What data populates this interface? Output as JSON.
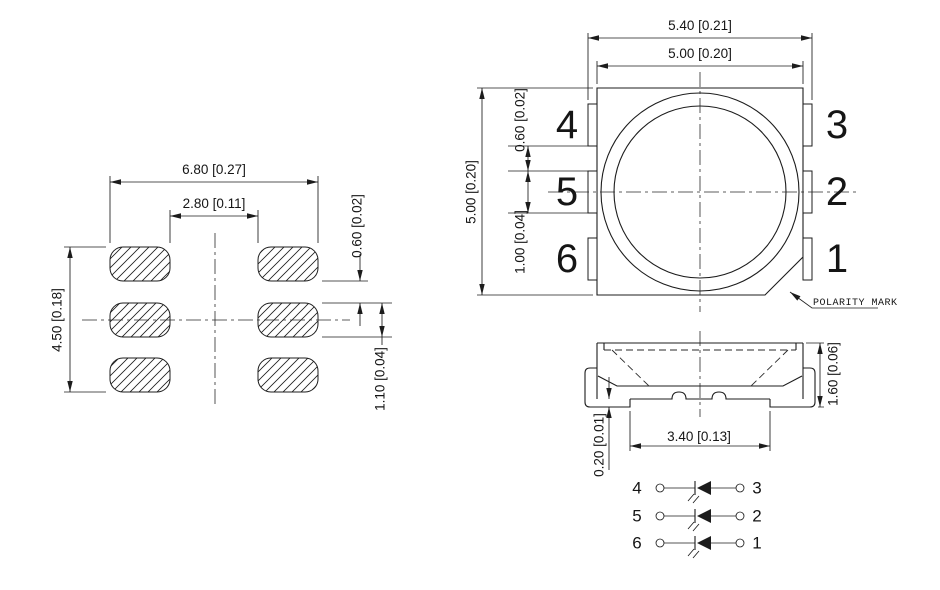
{
  "drawing": {
    "footprint": {
      "dim_outer_width": "6.80 [0.27]",
      "dim_inner_width": "2.80 [0.11]",
      "dim_overall_height": "4.50 [0.18]",
      "dim_pad_gap": "0.60 [0.02]",
      "dim_pad_height": "1.10 [0.04]"
    },
    "top_view": {
      "dim_overall_width": "5.40 [0.21]",
      "dim_body_width": "5.00 [0.20]",
      "dim_body_height": "5.00 [0.20]",
      "dim_lead_gap": "0.60 [0.02]",
      "dim_lead_width": "1.00 [0.04]",
      "pin_labels_left": [
        "4",
        "5",
        "6"
      ],
      "pin_labels_right": [
        "3",
        "2",
        "1"
      ],
      "polarity_label": "POLARITY MARK"
    },
    "side_view": {
      "dim_overall_height": "1.60 [0.06]",
      "dim_bottom_span": "3.40 [0.13]",
      "dim_lead_thickness": "0.20 [0.01]"
    },
    "schematic": {
      "rows": [
        {
          "left_pin": "4",
          "right_pin": "3"
        },
        {
          "left_pin": "5",
          "right_pin": "2"
        },
        {
          "left_pin": "6",
          "right_pin": "1"
        }
      ]
    },
    "colors": {
      "line": "#1c1c1c",
      "background": "#ffffff"
    }
  }
}
